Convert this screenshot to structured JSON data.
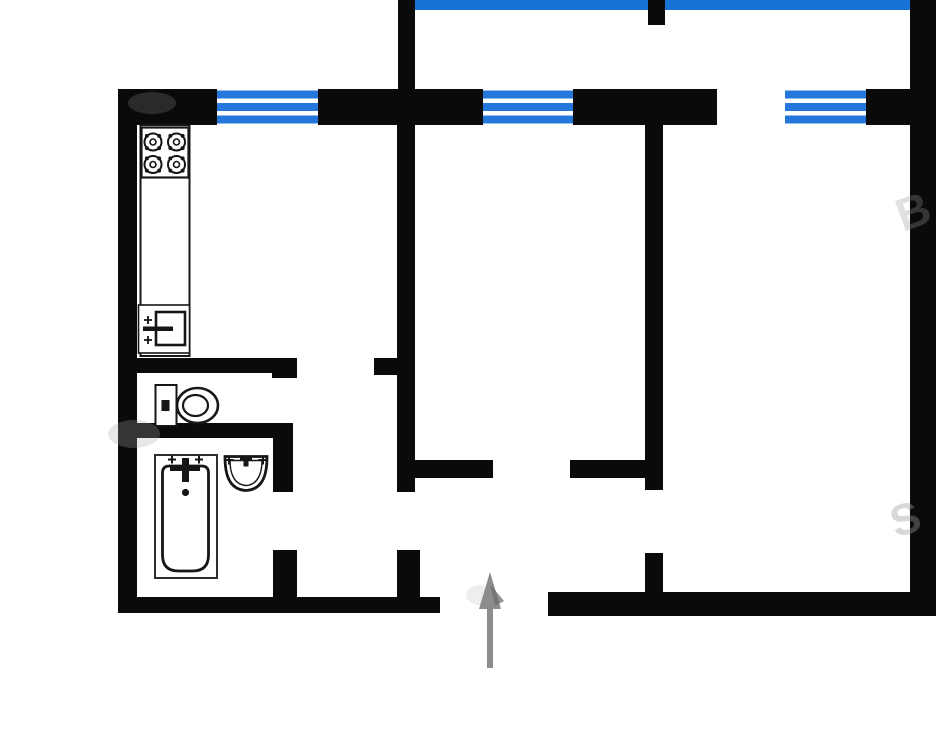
{
  "canvas": {
    "width": 940,
    "height": 740,
    "background": "#ffffff"
  },
  "palette": {
    "wall": "#0a0a0a",
    "window_blue": "#2577dc",
    "window_bg": "#ffffff",
    "balcony_glass": "#1873d6",
    "fixture_stroke": "#161616",
    "fixture_soft_stroke": "#2e2e2e",
    "fixture_fill": "#ffffff",
    "arrow_gray": "#8d8d8d",
    "arrow_dark": "#6f6f6f",
    "watermark_gray": "#9a9a9a"
  },
  "window_style": {
    "stripe_offsets": [
      1.5,
      14,
      26.5
    ],
    "stripe_height": 8
  },
  "rooms": [
    {
      "name": "room-balcony",
      "x": 415,
      "y": 10,
      "w": 495,
      "h": 79
    },
    {
      "name": "room-kitchen",
      "x": 137,
      "y": 125,
      "w": 260,
      "h": 233
    },
    {
      "name": "room-wc",
      "x": 137,
      "y": 373,
      "w": 136,
      "h": 50
    },
    {
      "name": "room-bathroom",
      "x": 137,
      "y": 438,
      "w": 136,
      "h": 159
    },
    {
      "name": "room-living",
      "x": 415,
      "y": 125,
      "w": 230,
      "h": 335
    },
    {
      "name": "room-bedroom",
      "x": 663,
      "y": 125,
      "w": 247,
      "h": 467
    },
    {
      "name": "room-corridor",
      "x": 297,
      "y": 375,
      "w": 100,
      "h": 222
    },
    {
      "name": "room-entrance-hall",
      "x": 420,
      "y": 478,
      "w": 225,
      "h": 114
    }
  ],
  "walls": [
    {
      "name": "outer-left-wall",
      "x": 118,
      "y": 89,
      "w": 19,
      "h": 524
    },
    {
      "name": "top-wall-segment-1",
      "x": 118,
      "y": 89,
      "w": 99,
      "h": 36
    },
    {
      "name": "top-wall-segment-2",
      "x": 318,
      "y": 89,
      "w": 165,
      "h": 36
    },
    {
      "name": "top-wall-segment-3",
      "x": 573,
      "y": 89,
      "w": 144,
      "h": 36
    },
    {
      "name": "top-wall-segment-4",
      "x": 866,
      "y": 89,
      "w": 66,
      "h": 36
    },
    {
      "name": "outer-right-wall",
      "x": 910,
      "y": 0,
      "w": 26,
      "h": 616
    },
    {
      "name": "bottom-wall-left",
      "x": 118,
      "y": 597,
      "w": 322,
      "h": 16
    },
    {
      "name": "bottom-wall-right",
      "x": 548,
      "y": 592,
      "w": 388,
      "h": 24
    },
    {
      "name": "balcony-left-wall",
      "x": 398,
      "y": 0,
      "w": 17,
      "h": 89
    },
    {
      "name": "balcony-divider-stub",
      "x": 648,
      "y": 0,
      "w": 17,
      "h": 25
    },
    {
      "name": "living-room-left-wall",
      "x": 397,
      "y": 125,
      "w": 18,
      "h": 367
    },
    {
      "name": "kitchen-door-jamb",
      "x": 374,
      "y": 358,
      "w": 23,
      "h": 17
    },
    {
      "name": "hall-top-wall-left",
      "x": 415,
      "y": 460,
      "w": 78,
      "h": 18
    },
    {
      "name": "hall-stub-left",
      "x": 397,
      "y": 550,
      "w": 23,
      "h": 47
    },
    {
      "name": "bedroom-left-wall",
      "x": 645,
      "y": 125,
      "w": 18,
      "h": 365
    },
    {
      "name": "hall-top-wall-right",
      "x": 570,
      "y": 460,
      "w": 75,
      "h": 18
    },
    {
      "name": "bedroom-door-stub",
      "x": 645,
      "y": 553,
      "w": 18,
      "h": 39
    },
    {
      "name": "kitchen-south-wall",
      "x": 118,
      "y": 358,
      "w": 154,
      "h": 15
    },
    {
      "name": "kitchen-south-wall-endcap",
      "x": 272,
      "y": 358,
      "w": 25,
      "h": 20
    },
    {
      "name": "wc-south-wall",
      "x": 118,
      "y": 423,
      "w": 155,
      "h": 15
    },
    {
      "name": "bathroom-east-wall",
      "x": 273,
      "y": 423,
      "w": 20,
      "h": 69
    },
    {
      "name": "bathroom-door-stub",
      "x": 273,
      "y": 550,
      "w": 24,
      "h": 47
    }
  ],
  "windows": [
    {
      "name": "kitchen-window",
      "x": 217,
      "y": 89,
      "w": 101,
      "h": 36
    },
    {
      "name": "living-room-window",
      "x": 483,
      "y": 89,
      "w": 90,
      "h": 36
    },
    {
      "name": "bedroom-window",
      "x": 785,
      "y": 89,
      "w": 81,
      "h": 36
    }
  ],
  "balcony_band": {
    "name": "balcony-glazing-band",
    "x": 415,
    "y": 0,
    "w": 495,
    "h": 10
  },
  "fixtures": {
    "counter": {
      "x": 140.5,
      "y": 125,
      "w": 49,
      "h": 231
    },
    "stove": {
      "x": 141.5,
      "y": 127.5,
      "w": 47,
      "h": 50,
      "burner_r": 8.5,
      "burners": [
        [
          153,
          142
        ],
        [
          176.5,
          142
        ],
        [
          153,
          164.5
        ],
        [
          176.5,
          164.5
        ]
      ]
    },
    "sink": {
      "box": [
        138.5,
        305,
        51,
        48
      ],
      "basin": [
        156,
        312,
        29,
        33
      ],
      "spout": [
        143,
        326.5,
        30,
        4.5
      ],
      "taps": [
        [
          148,
          320
        ],
        [
          148,
          340
        ]
      ]
    },
    "toilet": {
      "tank": [
        155.5,
        385,
        21,
        41
      ],
      "tank_dot": [
        161.5,
        400,
        8,
        11
      ],
      "bowl_c": [
        197.5,
        405.5
      ],
      "bowl_r": [
        20.5,
        17.5
      ],
      "inner_r": [
        12.5,
        10.5
      ]
    },
    "bathtub": {
      "outer": [
        155,
        455,
        62,
        123
      ],
      "inner": [
        162.5,
        466,
        46,
        105
      ],
      "inner_radius_top": 7,
      "inner_radius_bottom": 16,
      "crossbar": [
        170,
        465.5,
        30,
        5.5
      ],
      "spout": [
        182,
        458,
        7,
        24
      ],
      "taps": [
        [
          172,
          459.5
        ],
        [
          199,
          459.5
        ]
      ],
      "drain": [
        185.5,
        492.5,
        3.6
      ]
    },
    "washbasin": {
      "cx": 246,
      "top_y": 456.5,
      "rx": 21,
      "depth": 34,
      "taps": [
        [
          229,
          460
        ],
        [
          263,
          460
        ]
      ],
      "spout_h": [
        240,
        455.5,
        12,
        5
      ],
      "spout_v": [
        243.5,
        455.5,
        5,
        11
      ]
    }
  },
  "entrance_arrow": {
    "name": "entrance-arrow",
    "tip": [
      490,
      572
    ],
    "head_w": 22,
    "head_l": 37,
    "shaft_w": 6,
    "tail_y": 668
  },
  "watermarks": [
    {
      "text": "B",
      "x": 903,
      "y": 232,
      "size": 46,
      "rot": -20,
      "opacity": 0.3
    },
    {
      "text": "S",
      "x": 896,
      "y": 538,
      "size": 44,
      "rot": -18,
      "opacity": 0.38
    }
  ],
  "smudges": [
    {
      "cx": 152,
      "cy": 103,
      "rx": 24,
      "ry": 11,
      "fill": "#777777",
      "opacity": 0.3
    },
    {
      "cx": 134,
      "cy": 434,
      "rx": 26,
      "ry": 14,
      "fill": "#aaaaaa",
      "opacity": 0.28
    },
    {
      "cx": 480,
      "cy": 595,
      "rx": 14,
      "ry": 10,
      "fill": "#bbbbbb",
      "opacity": 0.25
    }
  ]
}
